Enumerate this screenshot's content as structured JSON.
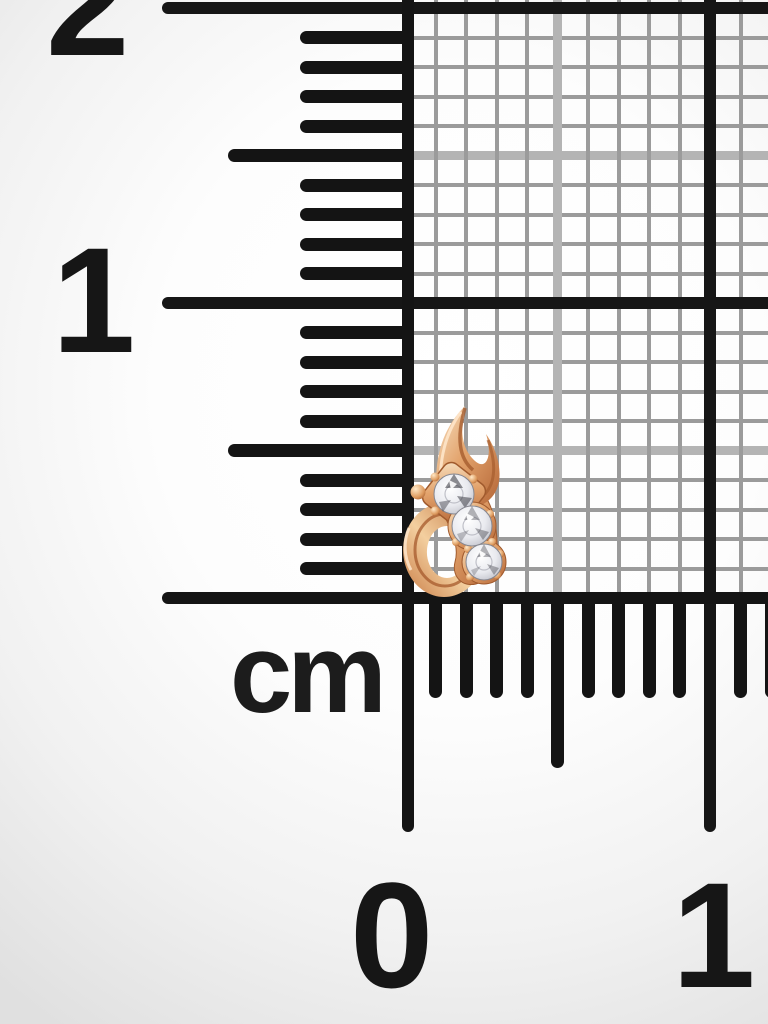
{
  "scene": {
    "description": "Macro product photo of a rose-gold earring with three round cubic-zirconia stones lying on millimeter graph paper next to an L-shaped centimeter ruler scale",
    "object_name": "rose-gold three-stone earring",
    "stone_count": 3
  },
  "ruler": {
    "unit_label": "cm",
    "vertical_labels": [
      {
        "text": "2"
      },
      {
        "text": "1"
      }
    ],
    "horizontal_labels": [
      {
        "text": "0"
      },
      {
        "text": "1"
      }
    ]
  },
  "colors": {
    "tick": "#141414",
    "grid_minor": "#9b9b9b",
    "grid_half": "#b4b4b4",
    "grid_major": "#161616",
    "label": "#161616",
    "background_corner": "#e0e0e0",
    "background_center": "#ffffff",
    "gold_light": "#f7e2c4",
    "gold_mid": "#e3a36c",
    "gold_deep": "#b26334",
    "stone": "#e9eaef"
  }
}
